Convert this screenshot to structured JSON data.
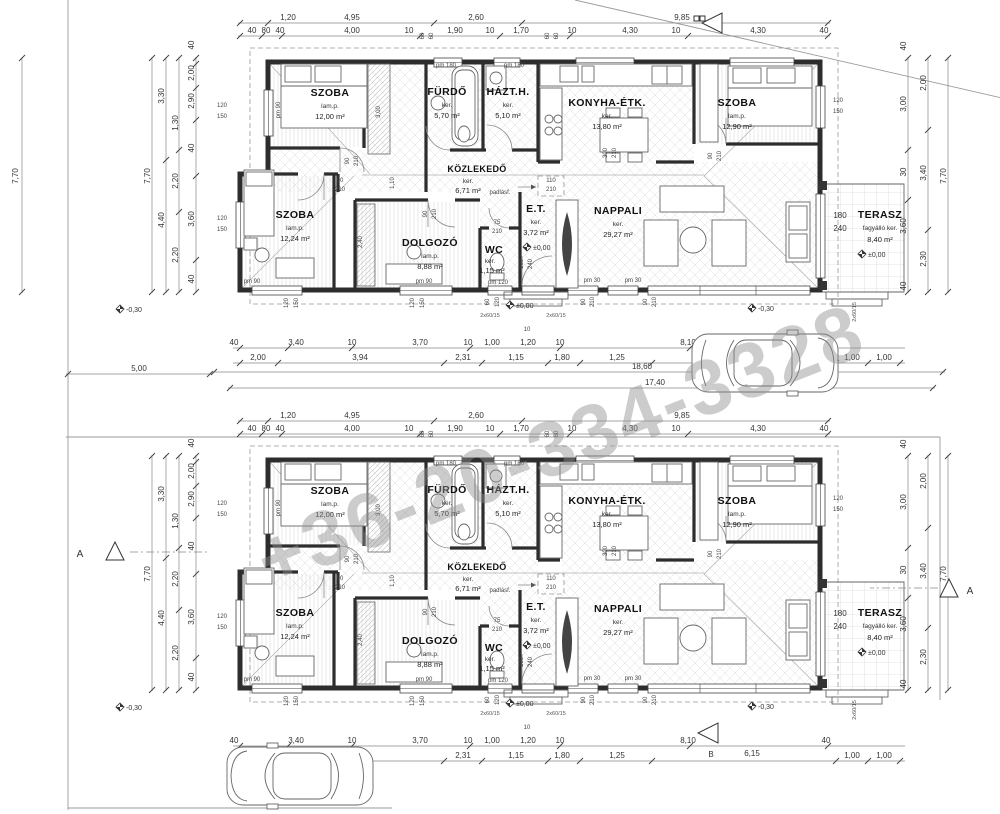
{
  "watermark": "+36-20-334-3328",
  "unit": {
    "rooms": {
      "szoba1": {
        "name": "SZOBA",
        "type": "lam.p.",
        "area": "12,00 m²"
      },
      "furdo": {
        "name": "FÜRDŐ",
        "type": "ker.",
        "area": "5,70 m²"
      },
      "hazth": {
        "name": "HÁZT.H.",
        "type": "ker.",
        "area": "5,10 m²"
      },
      "konyha": {
        "name": "KONYHA-ÉTK.",
        "type": "ker.",
        "area": "13,80 m²"
      },
      "szoba2": {
        "name": "SZOBA",
        "type": "lam.p.",
        "area": "12,90 m²"
      },
      "kozlekedo": {
        "name": "KÖZLEKEDŐ",
        "type": "ker.",
        "area": "6,71 m²",
        "note": "padlásf."
      },
      "szoba3": {
        "name": "SZOBA",
        "type": "lam.p.",
        "area": "12,24 m²"
      },
      "dolgozo": {
        "name": "DOLGOZÓ",
        "type": "lam.p.",
        "area": "8,88 m²"
      },
      "wc": {
        "name": "WC",
        "type": "ker.",
        "area": "1,15 m²"
      },
      "et": {
        "name": "E.T.",
        "type": "ker.",
        "area": "3,72 m²"
      },
      "nappali": {
        "name": "NAPPALI",
        "type": "ker.",
        "area": "29,27 m²"
      },
      "terasz": {
        "name": "TERASZ",
        "type": "fagyálló ker.",
        "area": "8,40 m²",
        "door_w": "180",
        "door_h": "240"
      }
    },
    "levels": {
      "zero": "±0,00",
      "minus030": "-0,30"
    },
    "dims": {
      "top1": [
        "1,20",
        "4,95",
        "2,60",
        "9,85"
      ],
      "top2": [
        "40",
        "80",
        "40",
        "4,00",
        "10",
        "60",
        "60",
        "1,90",
        "10",
        "1,70",
        "60",
        "60",
        "10",
        "4,30",
        "10",
        "4,30",
        "40"
      ],
      "left1": "7,70",
      "left2": [
        "3,30",
        "4,40"
      ],
      "left3": [
        "1,30",
        "2,20",
        "2,20"
      ],
      "left4": [
        "40",
        "2,00",
        "2,90",
        "40",
        "3,60",
        "40"
      ],
      "right1": [
        "40",
        "3,00",
        "30",
        "3,60",
        "40"
      ],
      "right2": [
        "2,00",
        "3,40",
        "2,30"
      ],
      "right3": "7,70",
      "bottom1": [
        "40",
        "3,40",
        "10",
        "3,70",
        "10",
        "1,00",
        "1,20",
        "10",
        "8,10",
        "40"
      ],
      "bottom2": [
        "2,00",
        "3,94",
        "2,31",
        "1,15",
        "1,80",
        "1,25",
        "1,00",
        "1,00"
      ],
      "inner": {
        "hall_w": "3,00",
        "study_w": "2,40",
        "door_gap": "1,10",
        "k300": "300",
        "h210": "210",
        "d90": "90",
        "d75": "75",
        "d110": "110",
        "d100": "100",
        "d240": "240",
        "w120": "120",
        "w150": "150",
        "d60": "60",
        "ten": "10"
      },
      "sills": {
        "pm180": "pm 180",
        "pm90": "pm 90",
        "pm30": "pm 30",
        "pm120": "pm 120"
      },
      "steps": "2x60/15"
    }
  },
  "site": {
    "outer_height": "7,70",
    "left_width": "5,00",
    "total_width": "18,60",
    "inner_width": "17,40",
    "bottom_width": "6,15",
    "section_a": "A",
    "section_b": "B"
  }
}
